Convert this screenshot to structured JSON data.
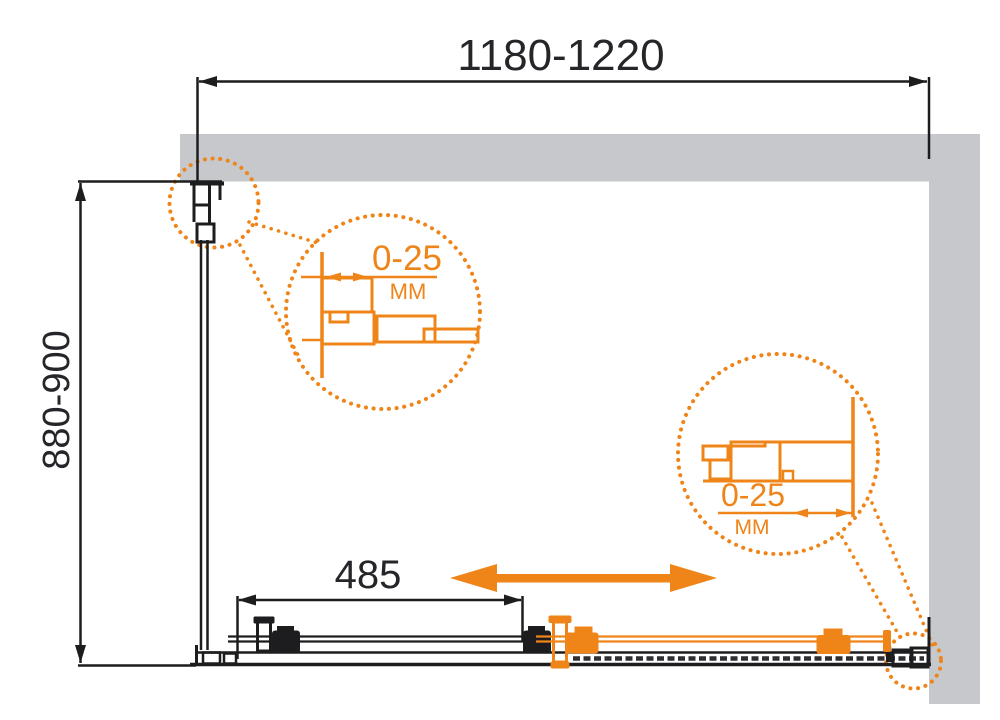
{
  "colors": {
    "accent": "#ef8418",
    "wall": "#c6c8cb",
    "ink": "#1d1d1f",
    "bg": "#ffffff"
  },
  "dimensions": {
    "width_range": "1180-1220",
    "depth_range": "880-900",
    "opening": "485"
  },
  "details": {
    "left": {
      "value": "0-25",
      "unit": "MM"
    },
    "right": {
      "value": "0-25",
      "unit": "MM"
    }
  }
}
